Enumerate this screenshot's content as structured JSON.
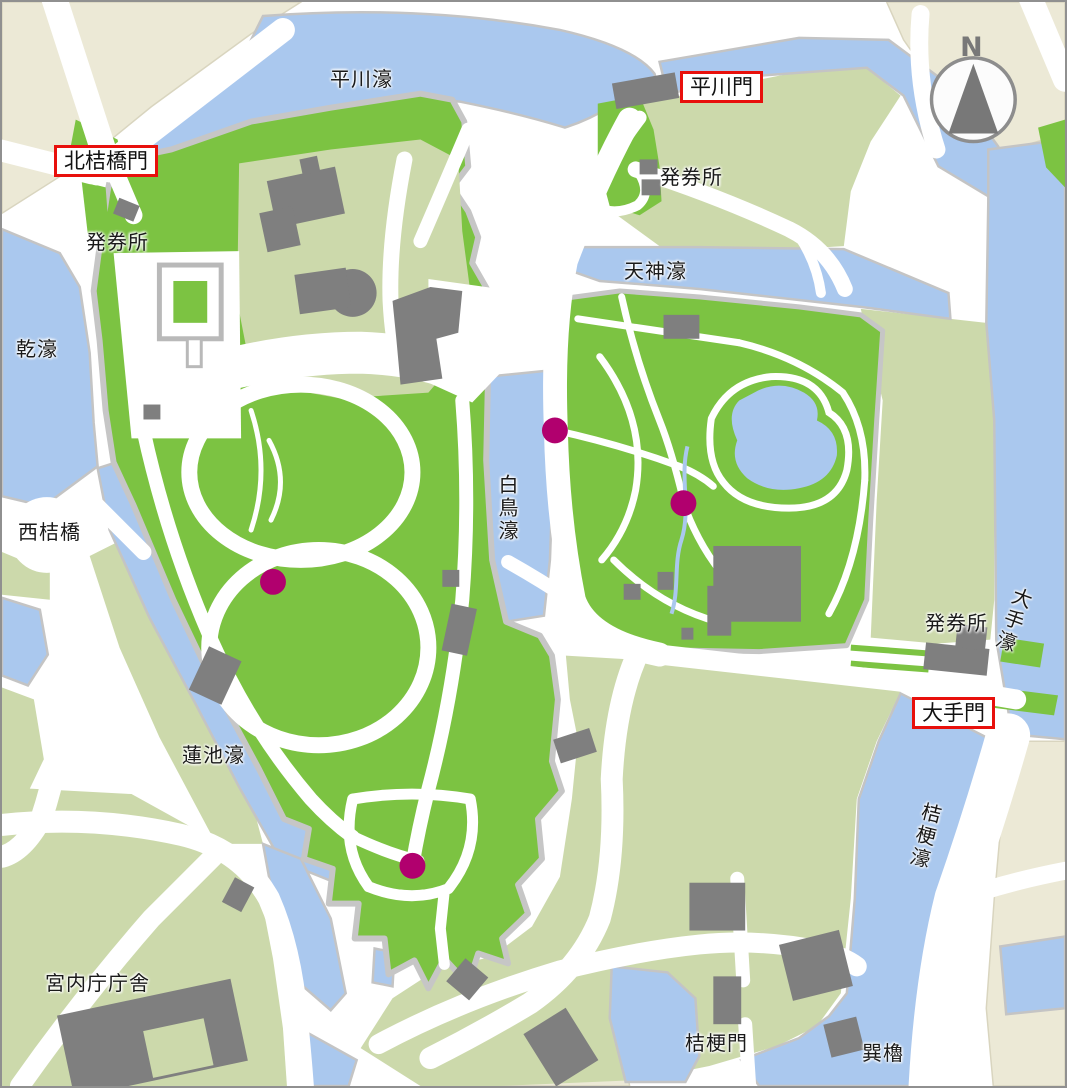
{
  "labels": {
    "hirakawa_moat": "平川濠",
    "hirakawa_gate": "平川門",
    "kitahanebashi_gate": "北桔橋門",
    "ticket_office_north": "発券所",
    "ticket_office_west": "発券所",
    "ticket_office_east": "発券所",
    "tenjin_moat": "天神濠",
    "inui_moat": "乾濠",
    "nishi_hanebashi": "西桔橋",
    "hakucho_moat": "白鳥濠",
    "ote_moat": "大手濠",
    "ote_gate": "大手門",
    "kikyo_moat": "桔梗濠",
    "hasuike_moat": "蓮池濠",
    "kunaicho_chosha": "宮内庁庁舎",
    "kikyo_gate": "桔梗門",
    "tatsumi_yagura": "巽櫓",
    "compass_n": "N"
  },
  "colors": {
    "water": "#aac8ee",
    "lawn_green": "#7cc342",
    "ground_green": "#ccd9ab",
    "outside_beige": "#ece9d6",
    "building_gray": "#7f7f7f",
    "wall_gray": "#c6c6c6",
    "road_white": "#ffffff",
    "marker_magenta": "#b1006e",
    "gate_box_border": "#e8100c",
    "compass_gray": "#787878"
  },
  "markers": {
    "color": "#b1006e",
    "radius": 13,
    "points": [
      {
        "x": 555,
        "y": 430
      },
      {
        "x": 684,
        "y": 503
      },
      {
        "x": 272,
        "y": 582
      },
      {
        "x": 412,
        "y": 867
      }
    ]
  }
}
